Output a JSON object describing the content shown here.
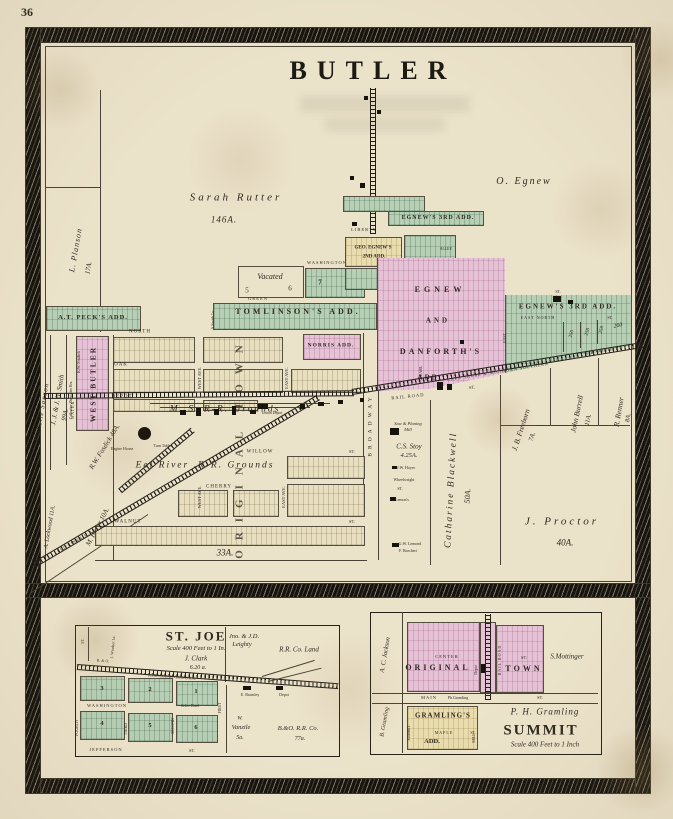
{
  "page": {
    "number": "36",
    "title": "BUTLER"
  },
  "colors": {
    "paper": "#ebe2ca",
    "green": "#b6cfb5",
    "pink": "#e6c2d7",
    "yellow": "#e9dcae",
    "cream": "#e8dec0",
    "ink": "#2f2a21"
  },
  "main": {
    "owners": {
      "planson": "L. Planson",
      "planson_a": "17A.",
      "rutter": "Sarah Rutter",
      "rutter_a": "146A.",
      "oegnew": "O. Egnew",
      "sanson": "Isabelle Sanson",
      "smith": "J. J. & J. N. Smith",
      "smith_a": "99A.",
      "kwfosdick": "K.W. Fosdick",
      "cathrs": "Catharine Showalter Hrs.",
      "rwfosdick": "R.W. Fosdick 48A.",
      "lockwood": "A. Lockwood 11A.",
      "hetler": "M. Hetler 10A.",
      "hubbell": "Lydia M. Hubbell",
      "hubbell_a": "33A.",
      "blackwell": "Catharine Blackwell",
      "blackwell_a": "50A.",
      "freeborn": "J. B. Freeborn",
      "freeborn_a": "7A.",
      "burrell": "John Burrell",
      "burrell_a": "11A.",
      "renner": "R. Renner",
      "renner_a": "8A.",
      "proctor": "J. Proctor",
      "proctor_a": "40A.",
      "stoy": "C.S. Stoy",
      "stoy_a": "4.25A.",
      "sawmill1": "Saw & Planing",
      "sawmill2": "Mill",
      "hoyer": "J.W. Hoyer",
      "wheelwright": "Wheelwright",
      "lemons": "Lemon's",
      "lemond": "G.W. Lemond",
      "borchert": "F. Borchert",
      "asmith": "A.Smith 1a."
    },
    "additions": {
      "peck": "A.T. PECK'S ADD.",
      "westbutler": "WEST BUTLER",
      "tomlinson": "TOMLINSON'S ADD.",
      "norris": "NORRIS ADD.",
      "egnew3": "EGNEW'S 3RD ADD.",
      "geoegnew2a": "GEO. EGNEW'S",
      "geoegnew2b": "2ND ADD.",
      "egnewword": "EGNEW",
      "andword": "AND",
      "danforths": "DANFORTH'S",
      "addword": "ADD.",
      "egnew3r": "EGNEW'S 3RD ADD.",
      "originaltown": "ORIGINAL TOWN",
      "vacated": "Vacated"
    },
    "blocks": {
      "b5": "5",
      "b6": "6",
      "b7": "7",
      "b8": "8"
    },
    "lots": {
      "l256": "256",
      "l258": "258",
      "l259": "259",
      "l260": "260"
    },
    "streets": {
      "north": "NORTH",
      "eastnorth": "EAST NORTH",
      "oak": "OAK",
      "depotst": "DEPOT",
      "green": "GREEN",
      "washington": "WASHINGTON",
      "liberty": "LIBERTY",
      "willow": "WILLOW",
      "cherry": "CHERRY",
      "walnut": "WALNUT",
      "railroad": "RAIL ROAD",
      "water": "WATER",
      "westave": "WEST AVE.",
      "eastave": "EAST AVE.",
      "broadway": "BROADWAY",
      "pearl": "PEARL",
      "alley": "ALLEY",
      "east": "EAST",
      "st": "ST."
    },
    "rr": {
      "msgrounds": "M. S.  R-R. Grounds",
      "eelgrounds": "Eel  River  .R-R. Grounds",
      "lsms": "LAKE SHORE & MICHIGAN SOUTHERN",
      "airline": "R.R. AIR LINE",
      "eelrr": "EEL RIVER R.R.",
      "enginehouse": "Engine House",
      "turntable": "Turn Table",
      "uniondepot": "Union Depot"
    }
  },
  "stjoe": {
    "title": "ST. JOE",
    "scale": "Scale 400 Feet to 1 In.",
    "clark": "J. Clark",
    "clark_a": "6.20 a.",
    "leighty1": "Jno. & J.D.",
    "leighty2": "Leighty",
    "rrco": "R.R. Co. Land",
    "bo": "B. & O.",
    "chicago": "(CHICAGO DIVISION)  R.R.",
    "windsor": "J. Windsor 1a.",
    "hotel": "St.Joe Hotel",
    "bromley": "E. Bromley",
    "depot": "Depot",
    "vanzile1": "W.",
    "vanzile2": "Vanzile",
    "vanzile3": "5a.",
    "boco": "B.&O. R.R. Co.",
    "boco_a": "77a.",
    "streets": {
      "washington": "WASHINGTON",
      "jefferson": "JEFFERSON",
      "fourth": "FOURTH",
      "third": "THIRD",
      "second": "SECOND",
      "first": "FIRST"
    },
    "blocks": {
      "b1": "1",
      "b2": "2",
      "b3": "3",
      "b4": "4",
      "b5": "5",
      "b6": "6"
    }
  },
  "summit": {
    "title": "SUMMIT",
    "scale": "Scale 400 Feet to 1 Inch",
    "original": "ORIGINAL",
    "town": "TOWN",
    "gramlings": "GRAMLING'S",
    "add": "ADD.",
    "jackson": "A. C. Jackson",
    "bgramling": "B. Gramling",
    "phgramling": "P. H. Gramling",
    "phsmall": "Ph.Gramling",
    "mottinger": "S.Mottinger",
    "depot": "Depot",
    "streets": {
      "center": "CENTER",
      "main": "MAIN",
      "maple": "MAPLE",
      "railroad": "RAIL ROAD",
      "summitst": "SUMMIT",
      "mill": "MILL"
    }
  }
}
